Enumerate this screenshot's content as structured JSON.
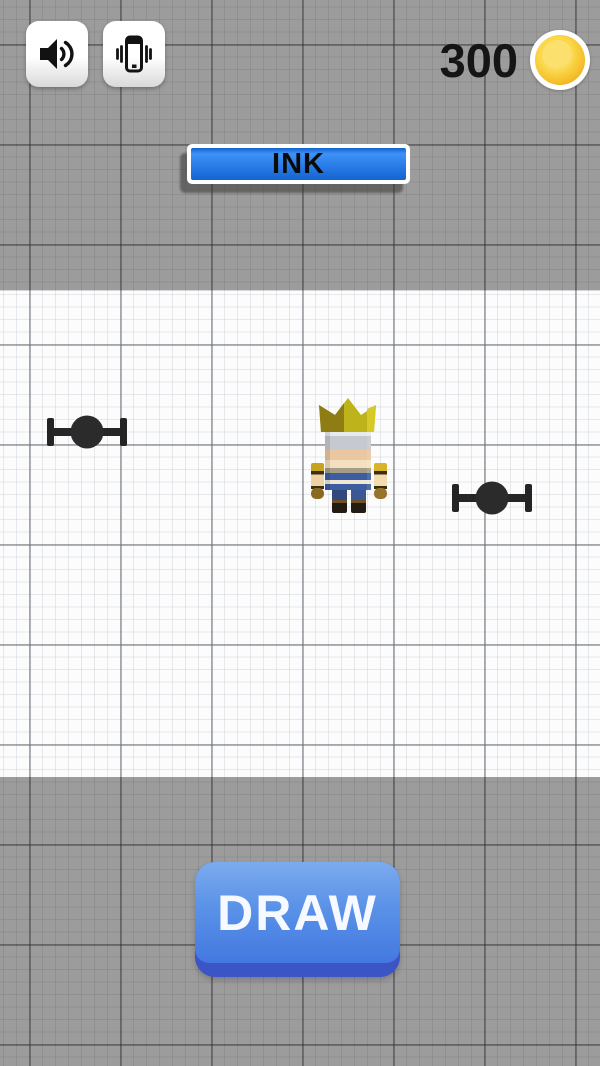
{
  "hud": {
    "sound_button": {
      "icon": "speaker-icon"
    },
    "vibrate_button": {
      "icon": "phone-vibrate-icon"
    },
    "coins": {
      "value": "300",
      "icon": "coin-icon",
      "coin_color": "#f4bd2a"
    }
  },
  "ink_bar": {
    "label": "INK",
    "fill_percent": 100,
    "fill_color_top": "#3f92f5",
    "fill_color_bottom": "#1464d2",
    "frame_color": "#ffffff",
    "text_color": "#0b0b0b"
  },
  "playfield": {
    "background": "graph-paper",
    "player": {
      "name": "crowned-blocky-character",
      "crown_color": "#bfb31b",
      "skin_color": "#eac7a0",
      "shirt_color": "#3e5da1",
      "shoe_color": "#241c12"
    },
    "obstacles": [
      {
        "name": "dumbbell-obstacle",
        "position": "left",
        "color": "#2a2a2a"
      },
      {
        "name": "dumbbell-obstacle",
        "position": "right",
        "color": "#2a2a2a"
      }
    ]
  },
  "draw_button": {
    "label": "DRAW",
    "color_top": "#7cabee",
    "color_bottom": "#4478e0",
    "edge_color": "#3b55c6",
    "text_color": "#f6f9ff"
  }
}
